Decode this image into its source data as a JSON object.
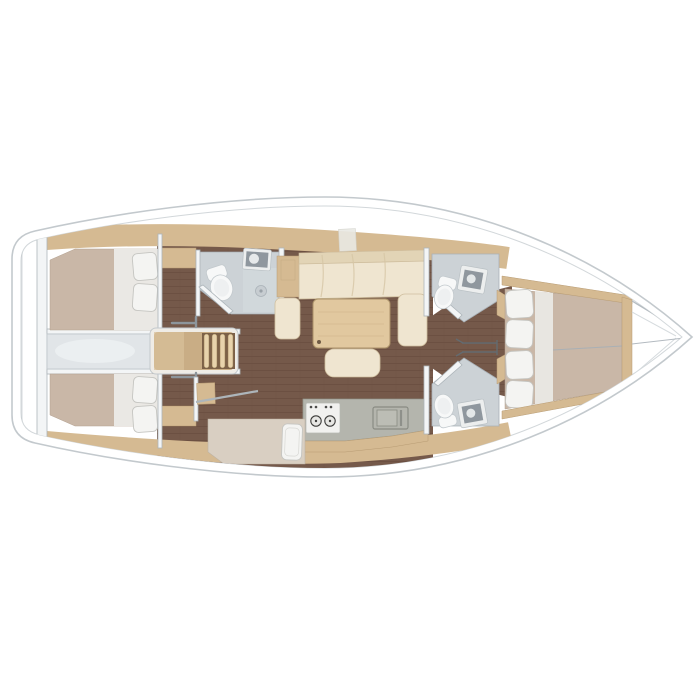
{
  "meta": {
    "title": "Sailing yacht interior floor plan",
    "view": "top-down",
    "orientation": "bow-right-stern-left",
    "layout_summary": "2 aft double cabins, companionway with engine box, aft head, saloon with U-sofa and table, linear galley, single-berth mid cabin, twin forward heads, forward V-berth double cabin"
  },
  "colors": {
    "background": "#ffffff",
    "hull_fill": "#ffffff",
    "hull_line": "#c3c9cd",
    "deck_band": "#d5ba92",
    "wood_floor": "#75594a",
    "wood_floor_line": "#63493b",
    "wall": "#f3f5f6",
    "wall_line": "#adb5ba",
    "mattress": "#c9b7a7",
    "bed_sheet": "#eae8e4",
    "pillow": "#f4f4f2",
    "sofa": "#efe5d0",
    "sofa_back": "#e2d4b6",
    "table_wood": "#e1c89f",
    "bath_floor": "#ccd2d6",
    "fixture_white": "#f7f8f8",
    "sink_dark": "#8f979e",
    "sink_frame": "#eceeee",
    "counter": "#b4b5ad",
    "stove": "#f1f1ef",
    "engine_box": "#e1e5e8",
    "steps_wood": "#c9ad85",
    "steps_slat": "#e8d3ac",
    "steps_gap": "#7c6148",
    "mid_bed": "#d9cfc2"
  },
  "areas": [
    {
      "id": "aft-cabin-port",
      "label": "Aft double cabin (port)",
      "features": [
        "double berth",
        "2 pillows",
        "locker"
      ]
    },
    {
      "id": "aft-cabin-starboard",
      "label": "Aft double cabin (starboard)",
      "features": [
        "double berth",
        "2 pillows",
        "locker"
      ]
    },
    {
      "id": "companionway",
      "label": "Companionway steps over engine box",
      "features": [
        "4-rung steps",
        "handrails"
      ]
    },
    {
      "id": "aft-head",
      "label": "Aft head (port)",
      "features": [
        "toilet",
        "sink",
        "shower drain",
        "door"
      ]
    },
    {
      "id": "saloon",
      "label": "Saloon",
      "features": [
        "U-shaped sofa",
        "dining table",
        "bench seat",
        "side locker"
      ]
    },
    {
      "id": "galley",
      "label": "Galley (starboard)",
      "features": [
        "2-burner stove",
        "sink",
        "worktop"
      ]
    },
    {
      "id": "mid-cabin",
      "label": "Single berth cabin (starboard)",
      "features": [
        "single berth",
        "pillow",
        "door"
      ]
    },
    {
      "id": "forward-head-port",
      "label": "Forward head (port)",
      "features": [
        "toilet",
        "sink"
      ]
    },
    {
      "id": "forward-head-starboard",
      "label": "Forward head (starboard)",
      "features": [
        "toilet",
        "sink"
      ]
    },
    {
      "id": "mast-foot",
      "label": "Mast foot / compression post"
    },
    {
      "id": "forward-cabin",
      "label": "Forward V-berth double cabin",
      "features": [
        "double berth",
        "4 pillows",
        "surround trim"
      ]
    },
    {
      "id": "bow-locker",
      "label": "Bow / anchor locker"
    }
  ]
}
